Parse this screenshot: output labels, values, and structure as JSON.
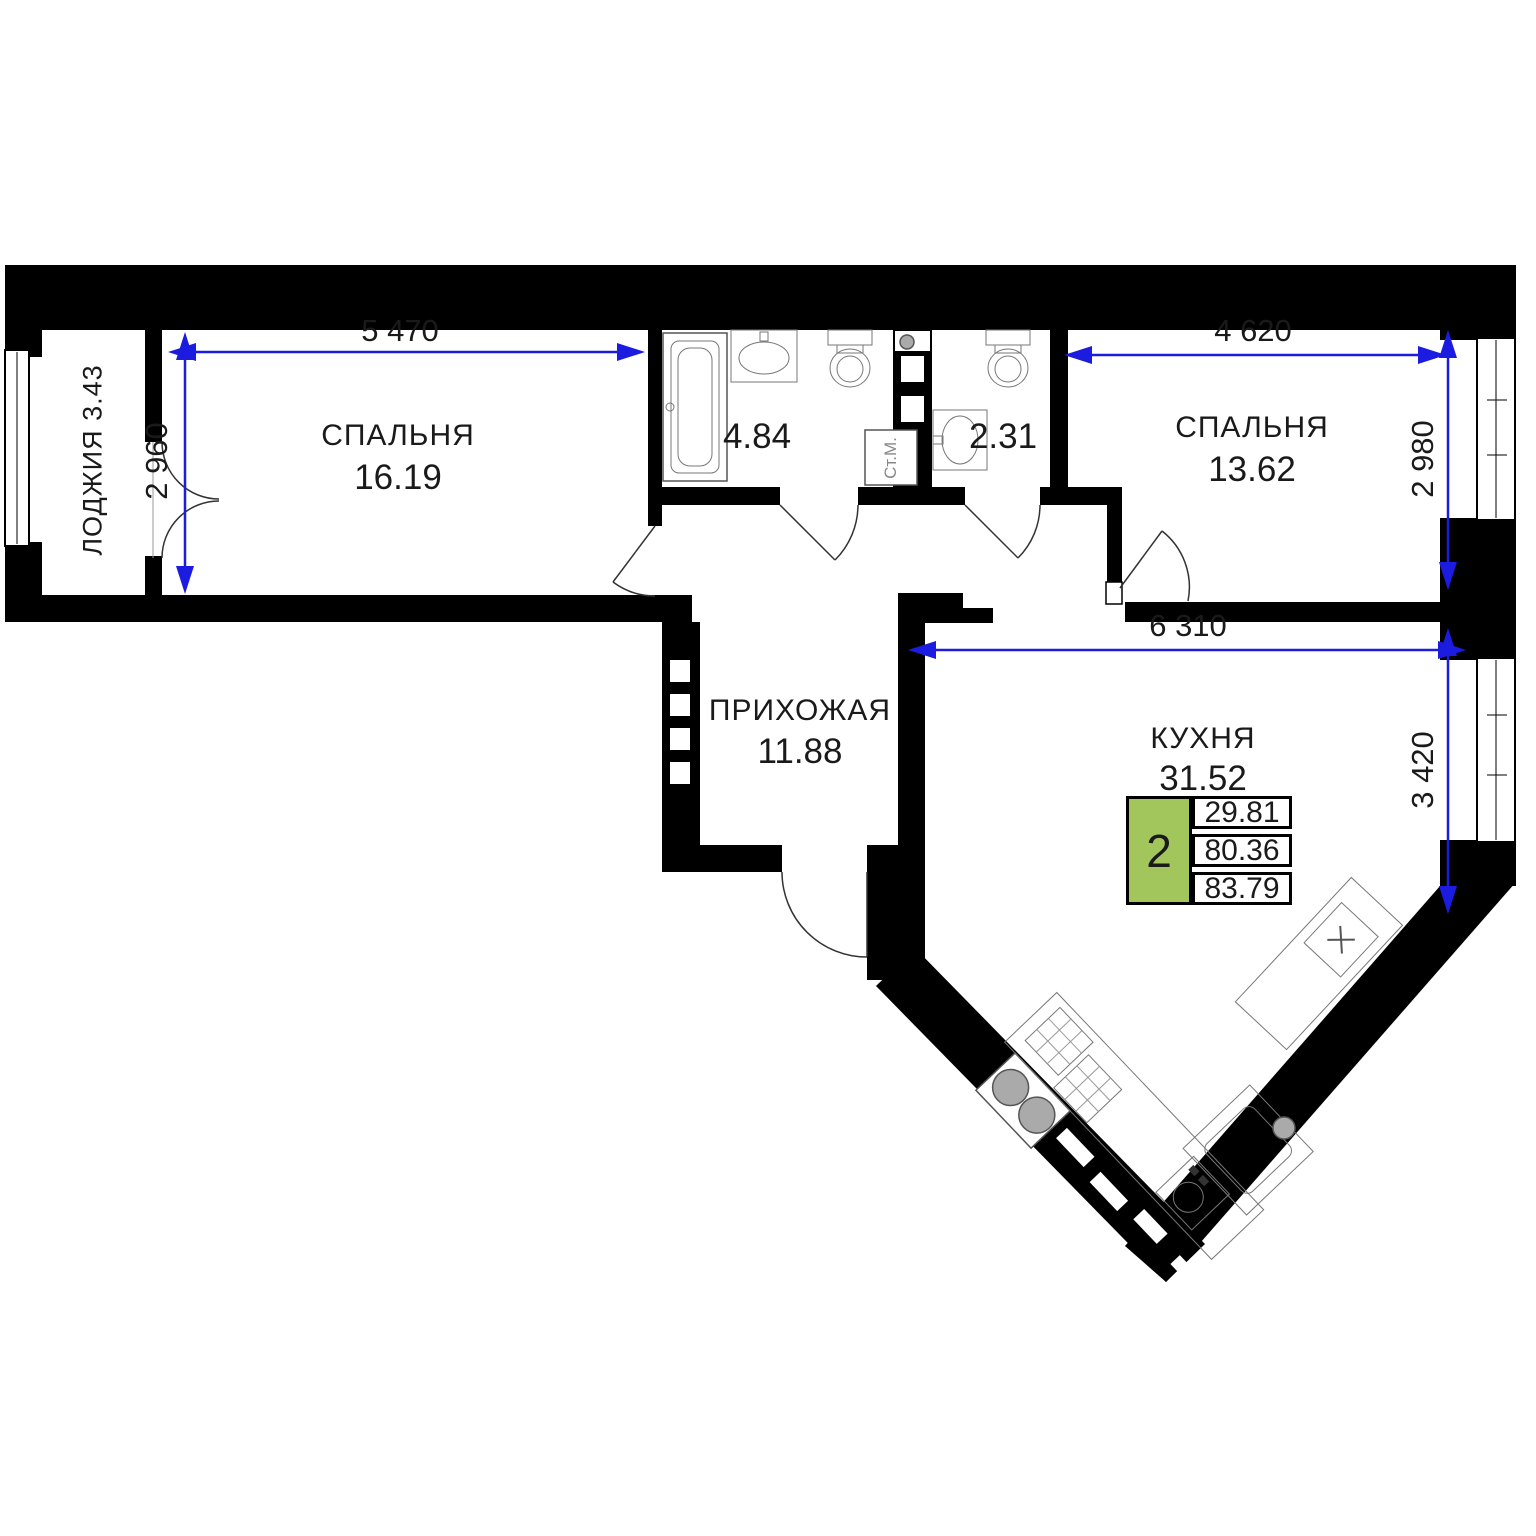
{
  "plan": {
    "rooms": {
      "loggia": {
        "label": "ЛОДЖИЯ",
        "area": "3.43"
      },
      "bedroom1": {
        "label": "СПАЛЬНЯ",
        "area": "16.19"
      },
      "bathroom": {
        "area": "4.84"
      },
      "washing_machine": {
        "label": "Ст.М."
      },
      "wc": {
        "area": "2.31"
      },
      "bedroom2": {
        "label": "СПАЛЬНЯ",
        "area": "13.62"
      },
      "hallway": {
        "label": "ПРИХОЖАЯ",
        "area": "11.88"
      },
      "kitchen": {
        "label": "КУХНЯ",
        "area": "31.52"
      }
    },
    "dimensions": {
      "bedroom1_width": "5 470",
      "bedroom1_height": "2 960",
      "bedroom2_width": "4 620",
      "bedroom2_height": "2 980",
      "kitchen_width": "6 310",
      "kitchen_height": "3 420"
    },
    "info_box": {
      "rooms_count": "2",
      "living_area": "29.81",
      "area_without_loggia": "80.36",
      "total_area": "83.79",
      "accent_color": "#a2c65b"
    },
    "colors": {
      "dimension": "#1c1ce0",
      "wall": "#000000"
    }
  }
}
